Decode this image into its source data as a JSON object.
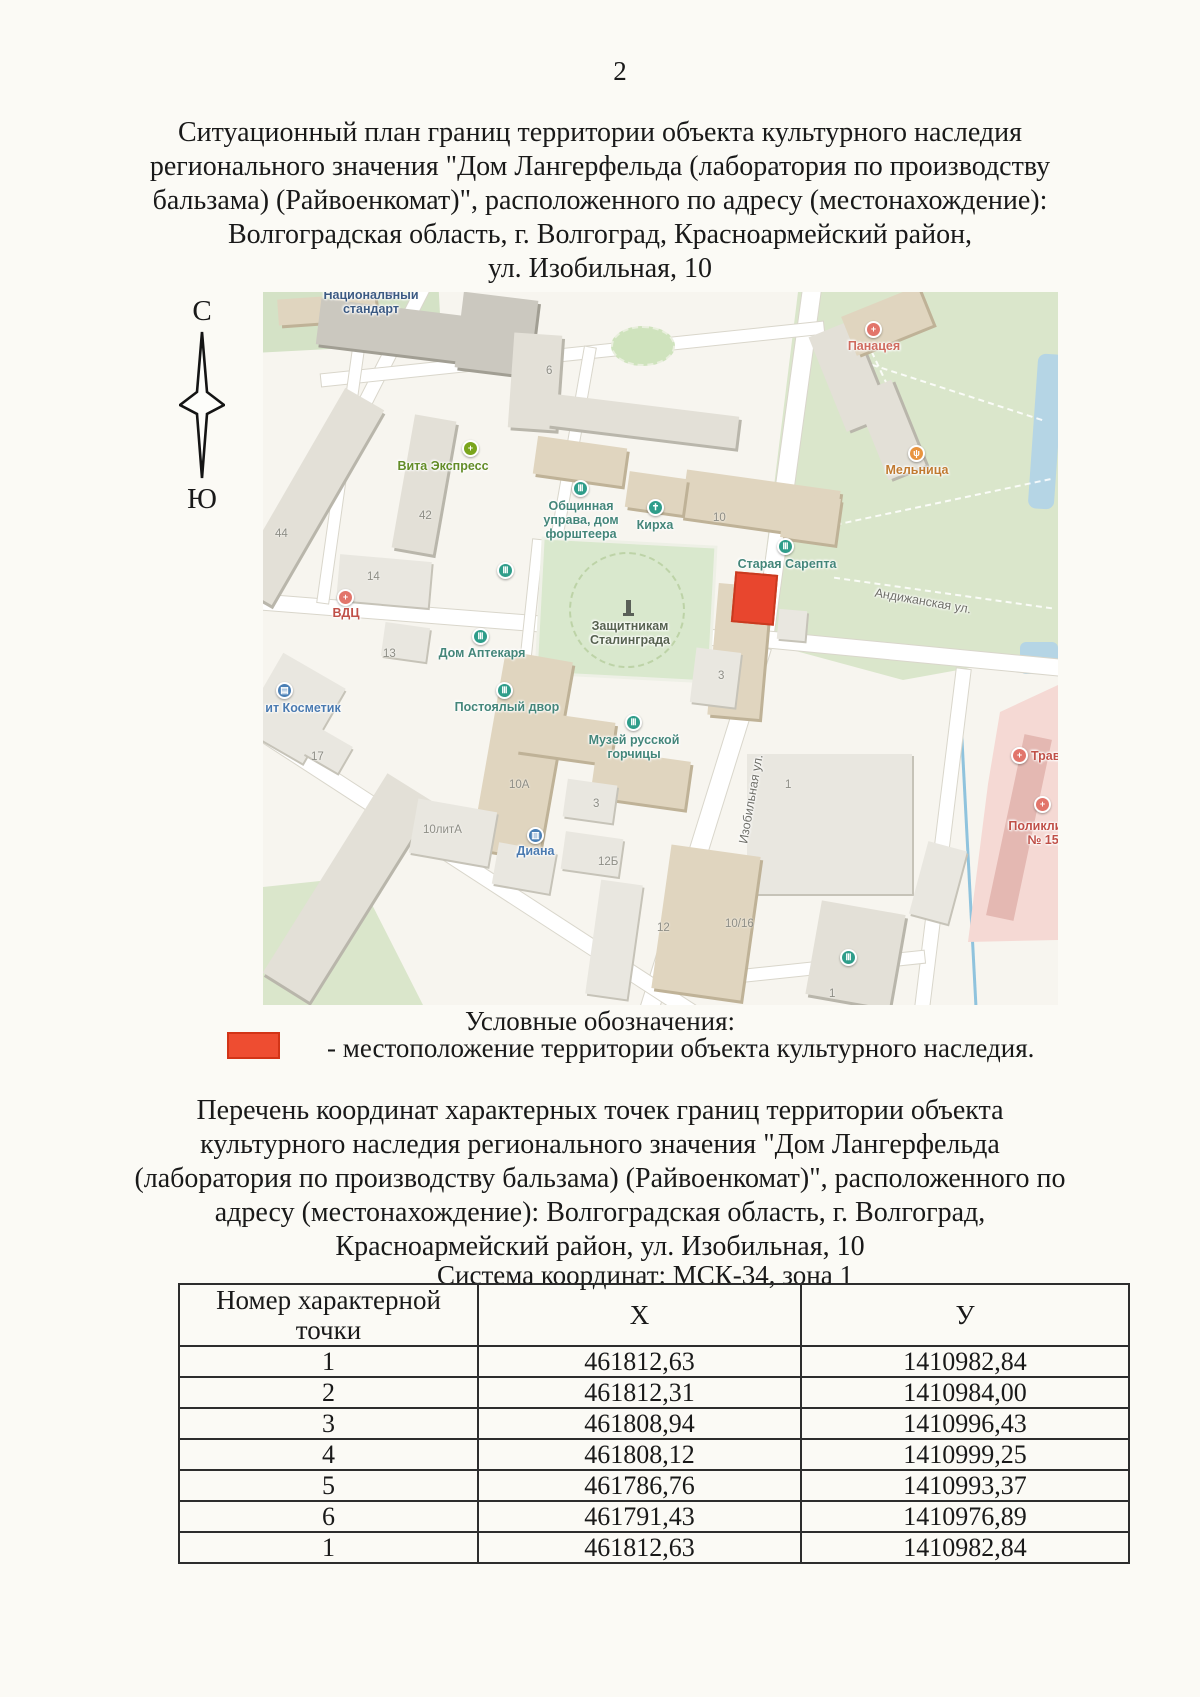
{
  "page": {
    "number": "2"
  },
  "headings": {
    "h1": "Ситуационный план границ территории объекта культурного наследия\nрегионального значения \"Дом Лангерфельда (лаборатория по производству\nбальзама) (Райвоенкомат)\", расположенного по адресу (местонахождение):\nВолгоградская область, г. Волгоград, Красноармейский район,\nул. Изобильная, 10",
    "h2": "Перечень координат характерных точек границ территории объекта\nкультурного наследия регионального значения \"Дом Лангерфельда\n(лаборатория по производству бальзама) (Райвоенкомат)\", расположенного по\nадресу (местонахождение): Волгоградская область, г. Волгоград,\nКрасноармейский район, ул. Изобильная, 10",
    "coord_system": "Система координат: МСК-34, зона 1"
  },
  "compass": {
    "north": "С",
    "south": "Ю"
  },
  "legend": {
    "title": "Условные обозначения:",
    "item": "- местоположение территории объекта культурного наследия.",
    "marker_color": "#ee4d31"
  },
  "map": {
    "marker_color": "#e8462e",
    "icons": {
      "museum": "Ⅲ",
      "medical": "+",
      "pharmacy": "+",
      "church": "✝",
      "shop": "▤",
      "basket": "▥",
      "food": "ψ",
      "metro": "Ⅲ"
    },
    "labels": {
      "nac_standart": "Национальный\nстандарт",
      "vita": "Вита Экспресс",
      "obshina": "Общинная\nуправа, дом\nфорштеера",
      "kirha": "Кирха",
      "sarepta": "Старая Сарепта",
      "zashitnikam": "Защитникам\nСталинграда",
      "aptekar": "Дом Аптекаря",
      "postoyaly": "Постоялый двор",
      "gorchitsa": "Музей русской\nгорчицы",
      "vdc": "ВДЦ",
      "kosmetik": "ит Косметик",
      "diana": "Диана",
      "panaceya": "Панацея",
      "melnitsa": "Мельница",
      "travm": "Трав",
      "poliklinika": "Поликлини\n№ 15",
      "andijanskaya": "Андижанская ул.",
      "izobilnaya": "Изобильная ул."
    },
    "numbers": {
      "n6": "6",
      "n42": "42",
      "n44": "44",
      "n14": "14",
      "n13": "13",
      "n17": "17",
      "n10": "10",
      "n10a": "10А",
      "n3a": "3",
      "n3b": "3",
      "n10lita": "10литА",
      "n12b": "12Б",
      "n12": "12",
      "n1016": "10/16",
      "n1a": "1",
      "n1b": "1"
    }
  },
  "table": {
    "headers": {
      "point": "Номер характерной\nточки",
      "x": "X",
      "y": "У"
    },
    "rows": [
      {
        "n": "1",
        "x": "461812,63",
        "y": "1410982,84"
      },
      {
        "n": "2",
        "x": "461812,31",
        "y": "1410984,00"
      },
      {
        "n": "3",
        "x": "461808,94",
        "y": "1410996,43"
      },
      {
        "n": "4",
        "x": "461808,12",
        "y": "1410999,25"
      },
      {
        "n": "5",
        "x": "461786,76",
        "y": "1410993,37"
      },
      {
        "n": "6",
        "x": "461791,43",
        "y": "1410976,89"
      },
      {
        "n": "1",
        "x": "461812,63",
        "y": "1410982,84"
      }
    ]
  }
}
